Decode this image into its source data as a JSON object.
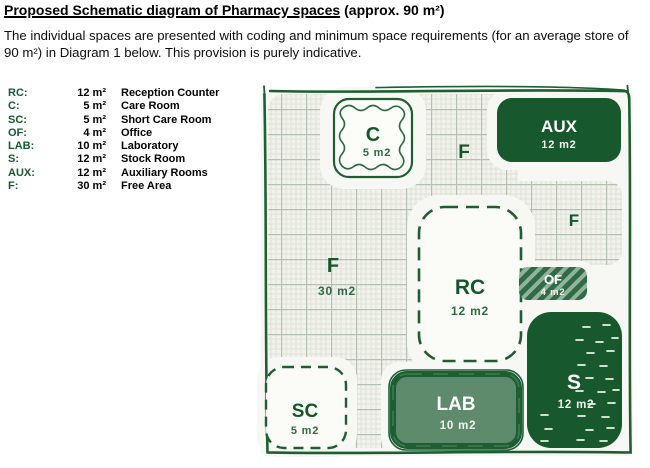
{
  "title": {
    "underlined": "Proposed Schematic diagram of Pharmacy spaces",
    "suffix": "(approx. 90 m²)"
  },
  "intro": "The individual spaces are presented with coding and minimum space requirements (for an average store of 90 m²) in Diagram 1 below. This provision is purely indicative.",
  "legend": {
    "rows": [
      {
        "code": "RC:",
        "area": "12 m²",
        "name": "Reception Counter"
      },
      {
        "code": "C:",
        "area": "5 m²",
        "name": "Care Room"
      },
      {
        "code": "SC:",
        "area": "5 m²",
        "name": "Short Care Room"
      },
      {
        "code": "OF:",
        "area": "4 m²",
        "name": "Office"
      },
      {
        "code": "LAB:",
        "area": "10 m²",
        "name": "Laboratory"
      },
      {
        "code": "S:",
        "area": "12 m²",
        "name": "Stock Room"
      },
      {
        "code": "AUX:",
        "area": "12 m²",
        "name": "Auxiliary Rooms"
      },
      {
        "code": "F:",
        "area": "30 m²",
        "name": "Free Area"
      }
    ]
  },
  "diagram": {
    "caption": "Diagram 1",
    "rooms": [
      {
        "id": "c",
        "code": "C",
        "area": "5 m2"
      },
      {
        "id": "f-top",
        "code": "F"
      },
      {
        "id": "aux",
        "code": "AUX",
        "area": "12 m2"
      },
      {
        "id": "f-right",
        "code": "F"
      },
      {
        "id": "f-main",
        "code": "F",
        "area": "30 m2"
      },
      {
        "id": "rc",
        "code": "RC",
        "area": "12 m2"
      },
      {
        "id": "of",
        "code": "OF",
        "area": "4 m2"
      },
      {
        "id": "s",
        "code": "S",
        "area": "12 m2"
      },
      {
        "id": "sc",
        "code": "SC",
        "area": "5 m2"
      },
      {
        "id": "lab",
        "code": "LAB",
        "area": "10 m2"
      }
    ],
    "colors": {
      "dark_green": "#17592c",
      "sage_green": "#5d8b6b",
      "label_green": "#14572b",
      "hatch_light": "#93b29c",
      "grid_paper": "#f1f2ec",
      "background": "#f7f8f4"
    }
  }
}
